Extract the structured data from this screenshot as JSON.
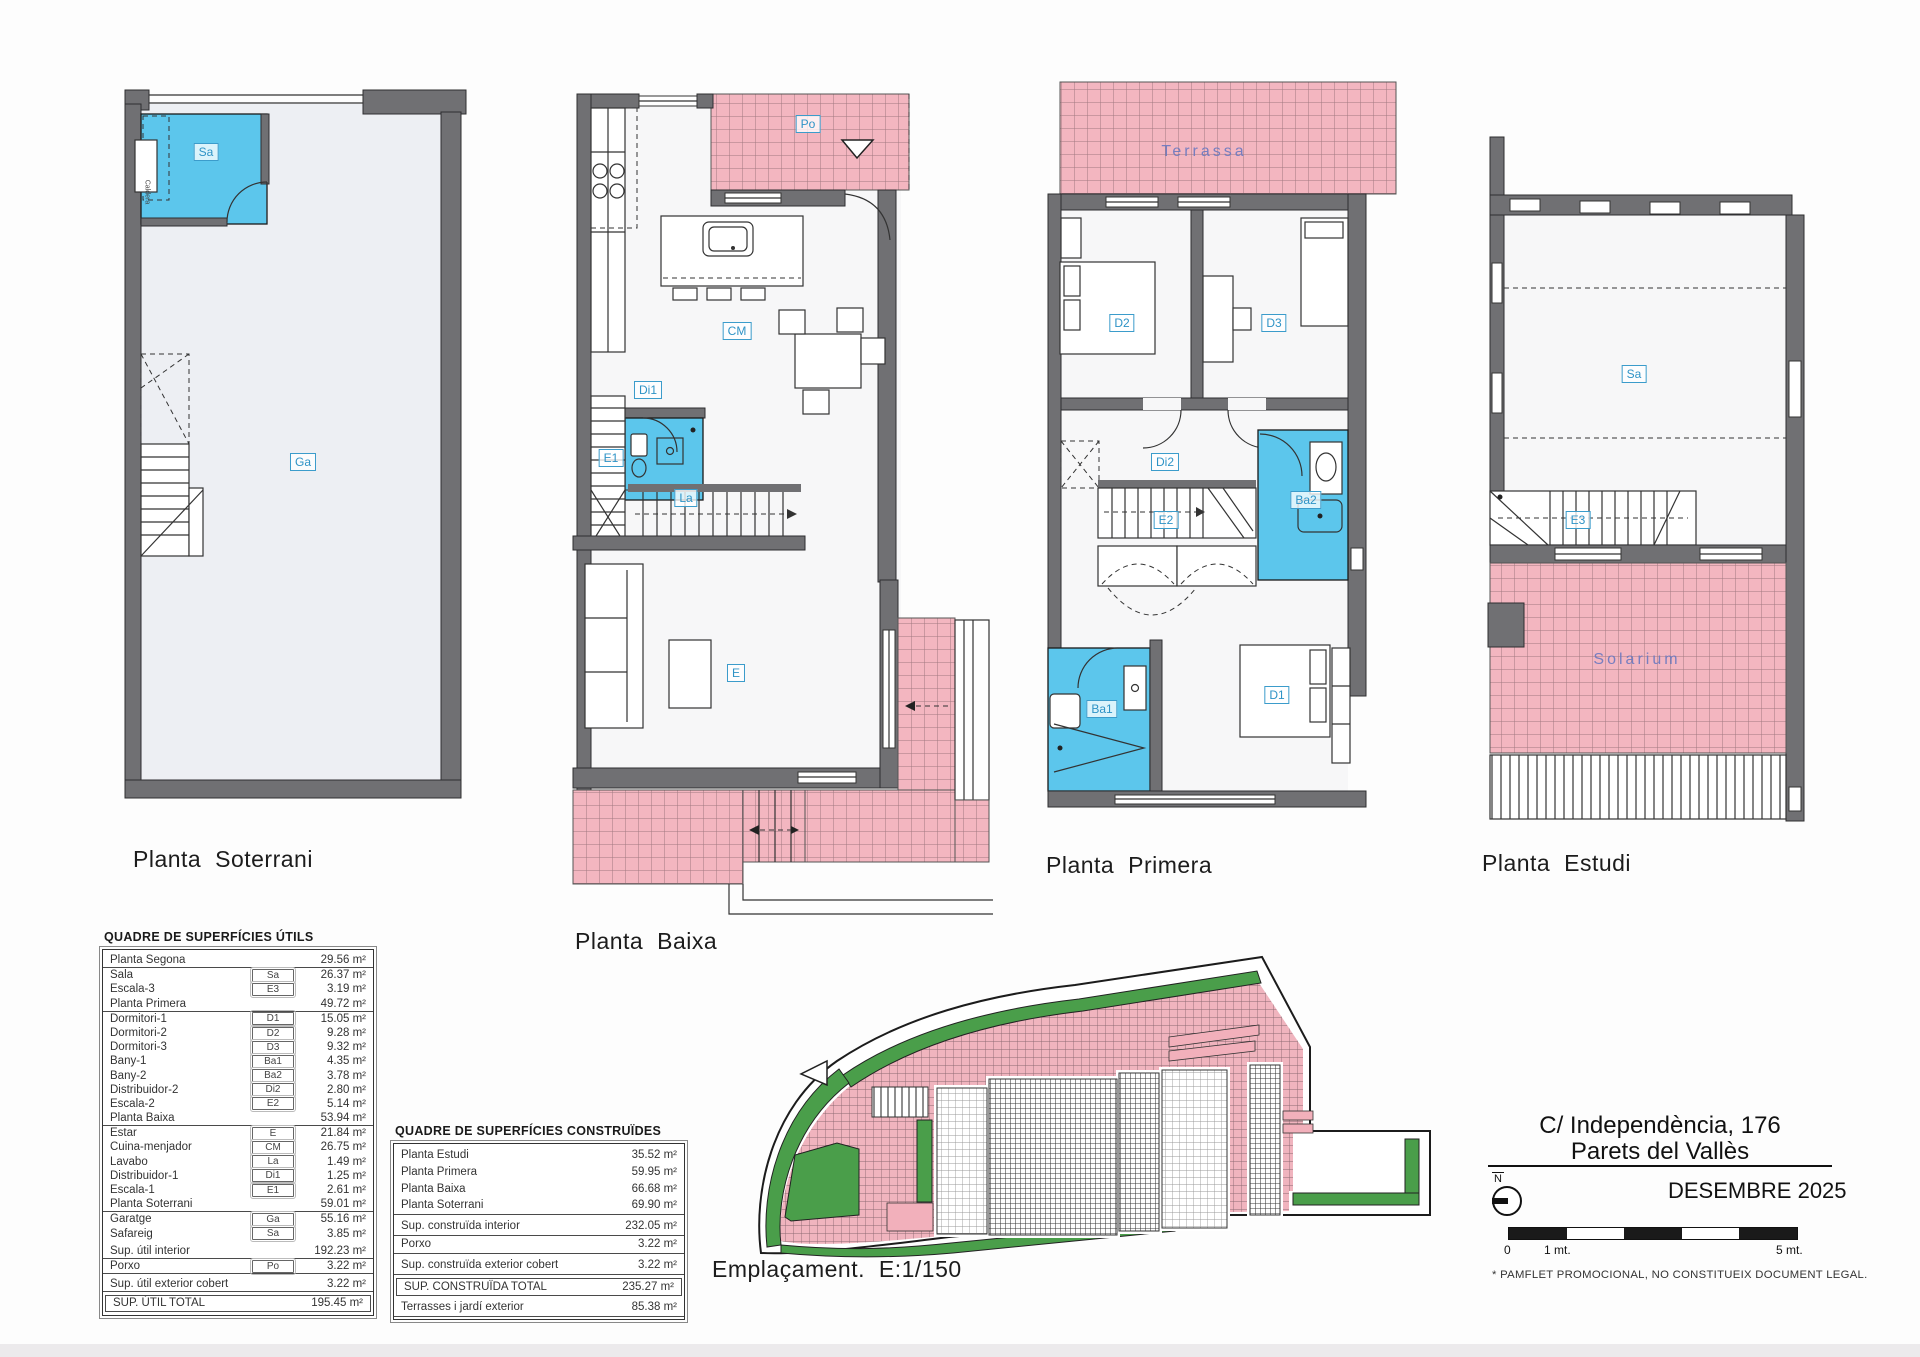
{
  "plans": {
    "soterrani": {
      "title": "Planta Soterrani",
      "labels": {
        "sa": "Sa",
        "ga": "Ga",
        "caldera": "Caldera"
      }
    },
    "baixa": {
      "title": "Planta Baixa",
      "labels": {
        "po": "Po",
        "cm": "CM",
        "di1": "Di1",
        "la": "La",
        "e1": "E1",
        "e": "E"
      }
    },
    "primera": {
      "title": "Planta Primera",
      "labels": {
        "terrassa": "Terrassa",
        "d2": "D2",
        "d3": "D3",
        "di2": "Di2",
        "e2": "E2",
        "ba2": "Ba2",
        "ba1": "Ba1",
        "d1": "D1"
      }
    },
    "estudi": {
      "title": "Planta Estudi",
      "labels": {
        "sa": "Sa",
        "e3": "E3",
        "solarium": "Solarium"
      }
    }
  },
  "siteplan": {
    "title": "Emplaçament. E:1/150"
  },
  "tables": {
    "utils": {
      "title": "QUADRE DE SUPERFÍCIES ÚTILS",
      "rows": [
        {
          "type": "section",
          "name": "Planta Segona",
          "value": "29.56 m²"
        },
        {
          "type": "item",
          "name": "Sala",
          "code": "Sa",
          "value": "26.37 m²"
        },
        {
          "type": "item",
          "name": "Escala-3",
          "code": "E3",
          "value": "3.19 m²"
        },
        {
          "type": "section",
          "name": "Planta Primera",
          "value": "49.72 m²"
        },
        {
          "type": "item",
          "name": "Dormitori-1",
          "code": "D1",
          "value": "15.05 m²"
        },
        {
          "type": "item",
          "name": "Dormitori-2",
          "code": "D2",
          "value": "9.28 m²"
        },
        {
          "type": "item",
          "name": "Dormitori-3",
          "code": "D3",
          "value": "9.32 m²"
        },
        {
          "type": "item",
          "name": "Bany-1",
          "code": "Ba1",
          "value": "4.35 m²"
        },
        {
          "type": "item",
          "name": "Bany-2",
          "code": "Ba2",
          "value": "3.78 m²"
        },
        {
          "type": "item",
          "name": "Distribuidor-2",
          "code": "Di2",
          "value": "2.80 m²"
        },
        {
          "type": "item",
          "name": "Escala-2",
          "code": "E2",
          "value": "5.14 m²"
        },
        {
          "type": "section",
          "name": "Planta Baixa",
          "value": "53.94 m²"
        },
        {
          "type": "item",
          "name": "Estar",
          "code": "E",
          "value": "21.84 m²"
        },
        {
          "type": "item",
          "name": "Cuina-menjador",
          "code": "CM",
          "value": "26.75 m²"
        },
        {
          "type": "item",
          "name": "Lavabo",
          "code": "La",
          "value": "1.49 m²"
        },
        {
          "type": "item",
          "name": "Distribuidor-1",
          "code": "Di1",
          "value": "1.25 m²"
        },
        {
          "type": "item",
          "name": "Escala-1",
          "code": "E1",
          "value": "2.61 m²"
        },
        {
          "type": "section",
          "name": "Planta Soterrani",
          "value": "59.01 m²"
        },
        {
          "type": "item",
          "name": "Garatge",
          "code": "Ga",
          "value": "55.16 m²"
        },
        {
          "type": "item",
          "name": "Safareig",
          "code": "Sa",
          "value": "3.85 m²"
        },
        {
          "type": "subtotal",
          "name": "Sup. útil interior",
          "value": "192.23 m²"
        },
        {
          "type": "item-rule",
          "name": "Porxo",
          "code": "Po",
          "value": "3.22 m²"
        },
        {
          "type": "subtotal",
          "name": "Sup. útil exterior cobert",
          "value": "3.22 m²"
        },
        {
          "type": "total",
          "name": "SUP. ÚTIL TOTAL",
          "value": "195.45 m²"
        }
      ]
    },
    "construides": {
      "title": "QUADRE DE SUPERFÍCIES CONSTRUÏDES",
      "rows": [
        {
          "type": "item",
          "name": "Planta Estudi",
          "value": "35.52 m²"
        },
        {
          "type": "item",
          "name": "Planta Primera",
          "value": "59.95 m²"
        },
        {
          "type": "item",
          "name": "Planta Baixa",
          "value": "66.68 m²"
        },
        {
          "type": "item-rule",
          "name": "Planta Soterrani",
          "value": "69.90 m²"
        },
        {
          "type": "subtotal",
          "name": "Sup. construïda interior",
          "value": "232.05 m²"
        },
        {
          "type": "item-rule",
          "name": "Porxo",
          "value": "3.22 m²"
        },
        {
          "type": "subtotal",
          "name": "Sup. construïda exterior cobert",
          "value": "3.22 m²"
        },
        {
          "type": "total",
          "name": "SUP. CONSTRUÏDA TOTAL",
          "value": "235.27 m²"
        },
        {
          "type": "subtotal",
          "name": "Terrasses i jardí exterior",
          "value": "85.38 m²"
        }
      ]
    }
  },
  "info": {
    "address_line1": "C/ Independència, 176",
    "address_line2": "Parets del Vallès",
    "date": "DESEMBRE 2025",
    "north_label": "N",
    "scale": {
      "zero": "0",
      "one": "1 mt.",
      "five": "5 mt."
    },
    "disclaimer": "* PAMFLET  PROMOCIONAL, NO CONSTITUEIX DOCUMENT LEGAL."
  },
  "colors": {
    "wall": "#707073",
    "room_blue": "#5cc6ec",
    "tile_pink": "#f3b6c0",
    "label_blue": "#2e93c6",
    "site_green": "#4a9e4a"
  }
}
